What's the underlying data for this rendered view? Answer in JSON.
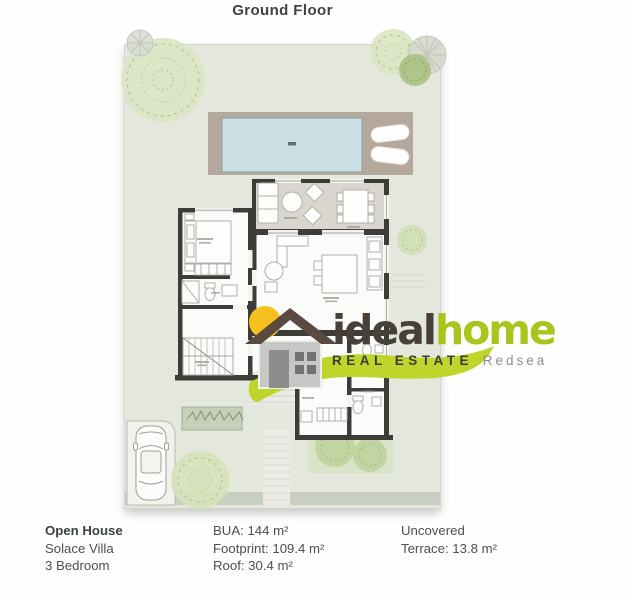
{
  "title": "Ground Floor",
  "logo": {
    "brand_primary": "ideal",
    "brand_secondary": "home",
    "tagline": "REAL ESTATE",
    "region": "Redsea"
  },
  "details": {
    "listing": {
      "heading": "Open House",
      "line1": "Solace Villa",
      "line2": "3 Bedroom"
    },
    "areas": {
      "bua": "BUA: 144 m²",
      "footprint": "Footprint: 109.4 m²",
      "roof": "Roof: 30.4 m²"
    },
    "terrace": {
      "line1": "Uncovered",
      "line2": "Terrace: 13.8 m²"
    }
  },
  "colors": {
    "accent_green": "#a8c51b",
    "brand_ink": "#474039",
    "sun_yellow": "#f4c11d",
    "roof_brown": "#5b4a40",
    "plot_green": "#e3e7dc",
    "pool_blue": "#c9dfe2",
    "deck_tan": "#b4a89c",
    "wall_dark": "#3e3c39"
  }
}
